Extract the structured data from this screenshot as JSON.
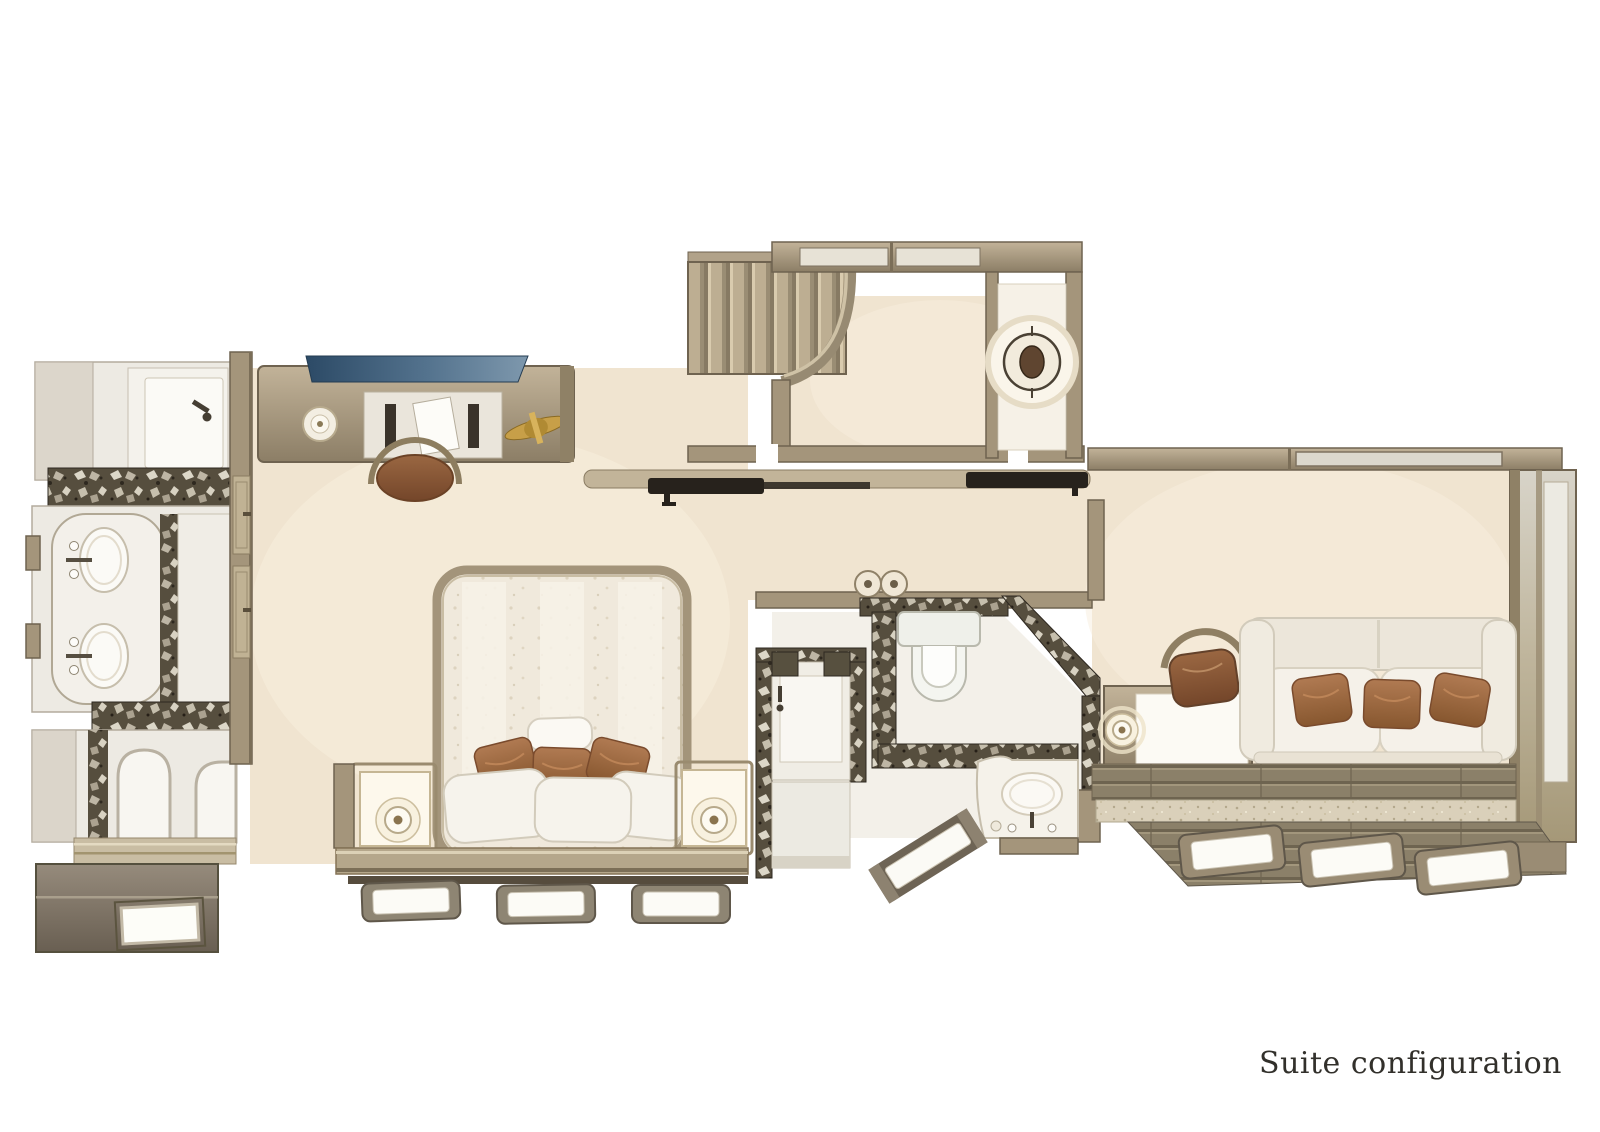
{
  "page": {
    "background": "#ffffff"
  },
  "caption": {
    "text": "Suite configuration"
  },
  "palette": {
    "page-bg": "#ffffff",
    "floor-cream": "#f0e4d0",
    "white-surface": "#f4f1ea",
    "wall-wood": "#a4957b",
    "wall-wood-dark": "#6f6350",
    "wood-light": "#c6b89d",
    "marble-dark": "#564e3e",
    "dark-bar": "#27221c",
    "dark-floor": "#7c7265",
    "glass-blue": "#3f5d7b",
    "glass-taupe": "#b9ac95",
    "pillow-brown": "#9d6b49",
    "seat-brown": "#8a5636",
    "lamp-glow": "#fdf8ec",
    "accent-gold": "#c79f48",
    "caption-color": "#32302b"
  }
}
